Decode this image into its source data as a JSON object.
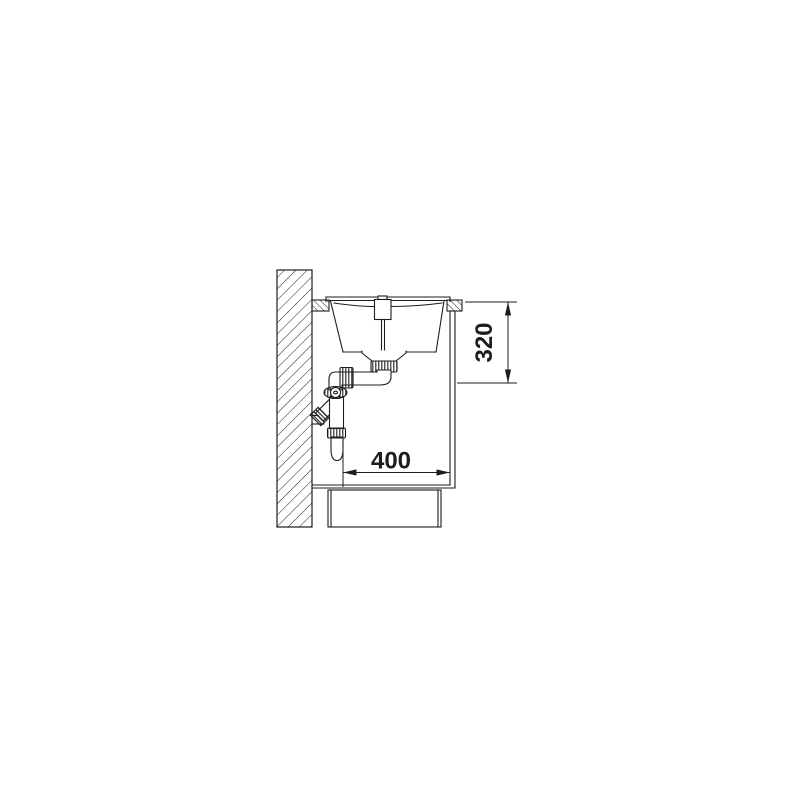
{
  "page": {
    "background_color": "#ffffff"
  },
  "drawing": {
    "name": "sink-installation-side-section-diagram",
    "line_color": "#1d1d1b",
    "dimensions": {
      "horizontal": "400",
      "vertical": "320"
    }
  }
}
